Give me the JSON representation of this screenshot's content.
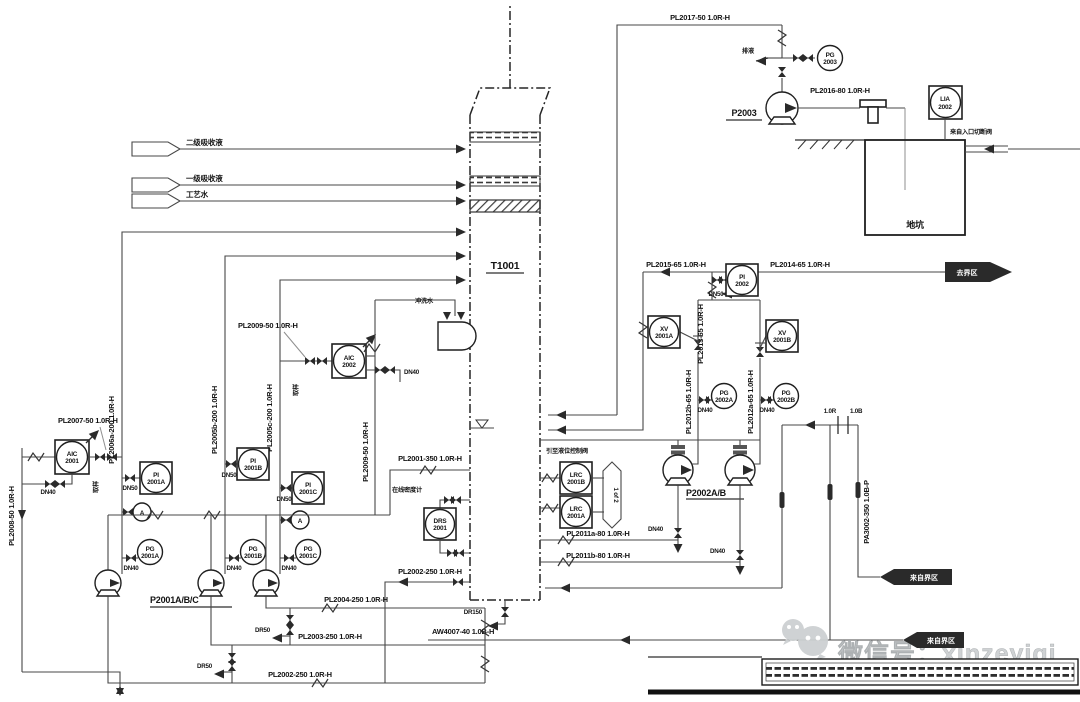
{
  "colors": {
    "line": "#474747",
    "dark": "#1f1f1f",
    "watermark": "#cdd0d2",
    "background": "#ffffff"
  },
  "equipment": {
    "tower": "T1001",
    "pump_group_left": "P2001A/B/C",
    "pump_group_right": "P2002A/B",
    "pit_pump": "P2003",
    "pit": "地坑"
  },
  "feeds": {
    "flag1": "二级吸收液",
    "flag2": "一级吸收液",
    "flag3": "工艺水"
  },
  "flags": {
    "right_out": "去界区",
    "right_in": "来自界区",
    "bottom_in": "来自界区"
  },
  "pipes": {
    "pl2017": "PL2017-50 1.0R-H",
    "pl2016": "PL2016-80 1.0R-H",
    "pl2015": "PL2015-65 1.0R-H",
    "pl2014": "PL2014-65 1.0R-H",
    "pl2013": "PL2013-65 1.0R-H",
    "pl2012a": "PL2012a-65 1.0R-H",
    "pl2012b": "PL2012b-65 1.0R-H",
    "pl2011a": "PL2011a-80 1.0R-H",
    "pl2011b": "PL2011b-80 1.0R-H",
    "pl2009": "PL2009-50 1.0R-H",
    "pl2008": "PL2008-50 1.0R-H",
    "pl2007": "PL2007-50 1.0R-H",
    "pl2006a": "PL2006a-200 1.0R-H",
    "pl2005b": "PL2005b-200 1.0R-H",
    "pl2005c": "PL2005c-200 1.0R-H",
    "pl2004": "PL2004-250 1.0R-H",
    "pl2003": "PL2003-250 1.0R-H",
    "pl2002": "PL2002-250 1.0R-H",
    "pl2001": "PL2001-350 1.0R-H",
    "pa3002": "PA3002-350 1.0B-P",
    "aw4007": "AW4007-40 1.0B-H"
  },
  "sizes": {
    "dn40": "DN40",
    "dn50": "DN50",
    "dr50": "DR50",
    "dr150": "DR150"
  },
  "instruments": {
    "aic2001": {
      "f": "AIC",
      "n": "2001"
    },
    "aic2002": {
      "f": "AIC",
      "n": "2002"
    },
    "pi2001a": {
      "f": "PI",
      "n": "2001A"
    },
    "pi2001b": {
      "f": "PI",
      "n": "2001B"
    },
    "pi2001c": {
      "f": "PI",
      "n": "2001C"
    },
    "pg2001a": {
      "f": "PG",
      "n": "2001A"
    },
    "pg2001b": {
      "f": "PG",
      "n": "2001B"
    },
    "pg2001c": {
      "f": "PG",
      "n": "2001C"
    },
    "pi2002": {
      "f": "PI",
      "n": "2002"
    },
    "pg2002a": {
      "f": "PG",
      "n": "2002A"
    },
    "pg2002b": {
      "f": "PG",
      "n": "2002B"
    },
    "pg2003": {
      "f": "PG",
      "n": "2003"
    },
    "xv2001a": {
      "f": "XV",
      "n": "2001A"
    },
    "xv2001b": {
      "f": "XV",
      "n": "2001B"
    },
    "lrc2001a": {
      "f": "LRC",
      "n": "2001A"
    },
    "lrc2001b": {
      "f": "LRC",
      "n": "2001B"
    },
    "lia2002": {
      "f": "LIA",
      "n": "2002"
    },
    "drs2001": {
      "f": "DRS",
      "n": "2001"
    },
    "analyzer": "A"
  },
  "annotations": {
    "flush_water": "冲洗水",
    "drain_liquid": "排液",
    "sample": "取样",
    "to_level_valve": "引至液位控制阀",
    "density_meter": "在线密度计",
    "tank_inlet": "来自入口切断阀",
    "selector": "1 of 2",
    "boundary_left": "1.0R",
    "boundary_right": "1.0B"
  },
  "watermark": {
    "handle": "微信号：xinzeyiqi"
  }
}
